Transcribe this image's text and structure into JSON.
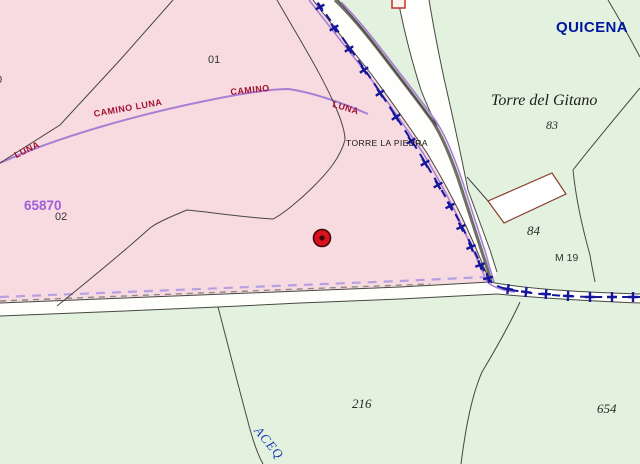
{
  "map": {
    "labels": {
      "municipality": "QUICENA",
      "place_name": "Torre del Gitano",
      "parcel_83": "83",
      "parcel_84": "84",
      "marker_m19": "M 19",
      "parcel_216": "216",
      "parcel_654": "654",
      "subparcel_01": "01",
      "subparcel_02": "02",
      "parcel_code_65870": "65870",
      "partial_parcel_left": "0",
      "place_torre_la_piedra": "TORRE LA PIEDRA",
      "road_camino_luna": "CAMINO LUNA",
      "road_camino": "CAMINO",
      "road_luna_left": "LUNA",
      "road_luna_right": "LUNA",
      "waterway_acequia": "ACEQ"
    },
    "colors": {
      "parcel_pink": "#f8dbe1",
      "parcel_green": "#e2f2de",
      "road_white": "#fefefc",
      "boundary_line": "#474740",
      "municipal_boundary_navy": "#16169b",
      "camino_purple": "#a87fd4",
      "camino_label_red": "#a01230",
      "municipality_blue": "#0016a0",
      "parcel_code_purple": "#a05fd8",
      "marker_red": "#d8121e",
      "building_outline_red": "#8b3a2a"
    }
  }
}
